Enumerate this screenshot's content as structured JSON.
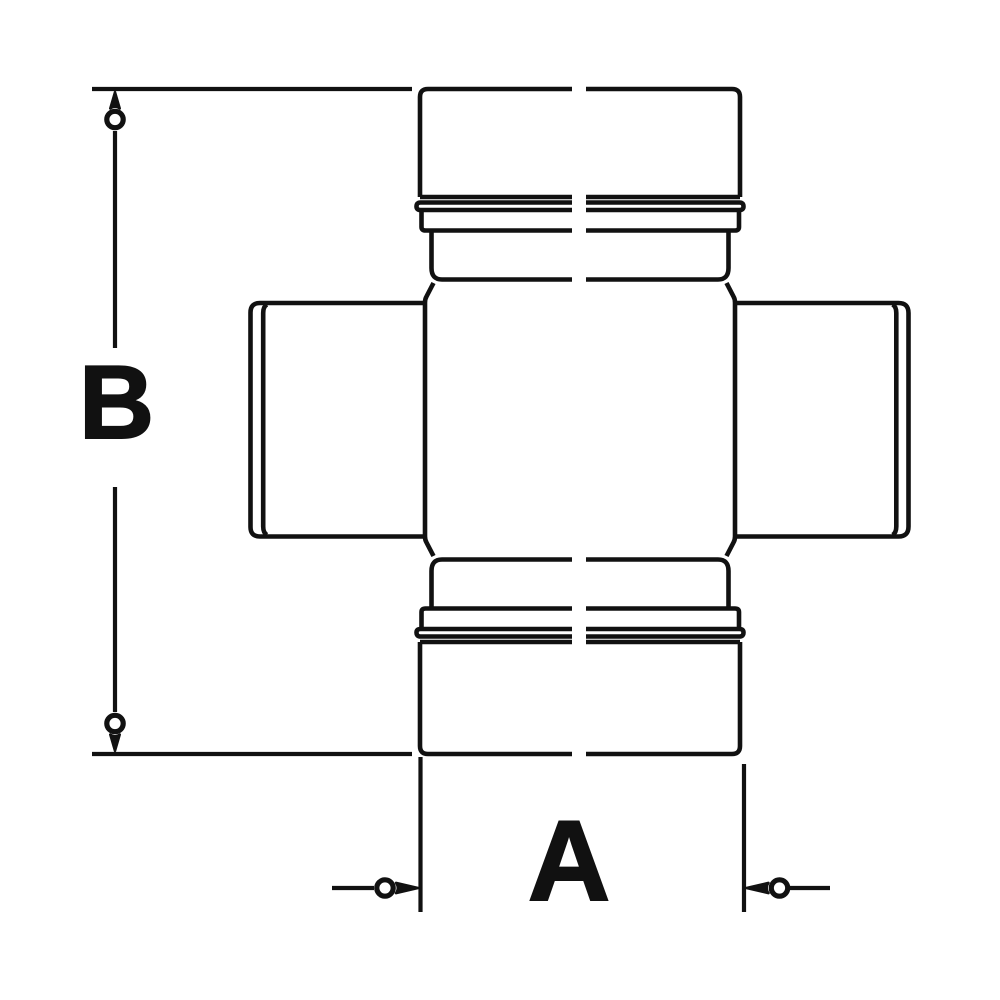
{
  "drawing": {
    "description": "technical line drawing of a universal joint cross with two dimension callouts",
    "colors": {
      "line": "#111111",
      "background": "#ffffff"
    },
    "labels": {
      "vertical_dimension": "B",
      "horizontal_dimension": "A"
    }
  }
}
